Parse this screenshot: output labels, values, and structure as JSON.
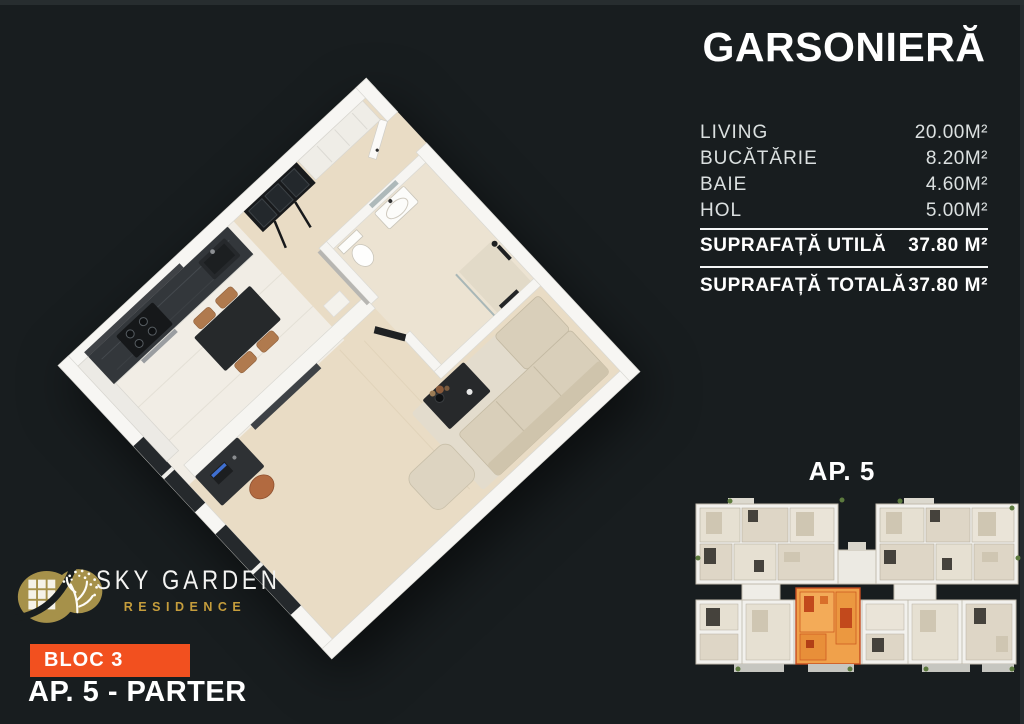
{
  "page": {
    "background_color": "#181d1f"
  },
  "header": {
    "title": "GARSONIERĂ"
  },
  "area_table": {
    "rooms": [
      {
        "label": "LIVING",
        "value": "20.00M²"
      },
      {
        "label": "BUCĂTĂRIE",
        "value": "8.20M²"
      },
      {
        "label": "BAIE",
        "value": "4.60M²"
      },
      {
        "label": "HOL",
        "value": "5.00M²"
      }
    ],
    "totals": [
      {
        "label": "SUPRAFAȚĂ UTILĂ",
        "value": "37.80 M²"
      },
      {
        "label": "SUPRAFAȚĂ TOTALĂ",
        "value": "37.80 M²"
      }
    ]
  },
  "key_plan": {
    "label": "AP. 5",
    "highlight_color": "#f0a14b"
  },
  "brand": {
    "name": "SKY GARDEN",
    "subtitle": "RESIDENCE",
    "logo_color": "#a6914a",
    "subtitle_color": "#c59d3c"
  },
  "footer": {
    "block_badge": "BLOC 3",
    "badge_color": "#f2501f",
    "apartment_label": "AP. 5 - PARTER"
  }
}
